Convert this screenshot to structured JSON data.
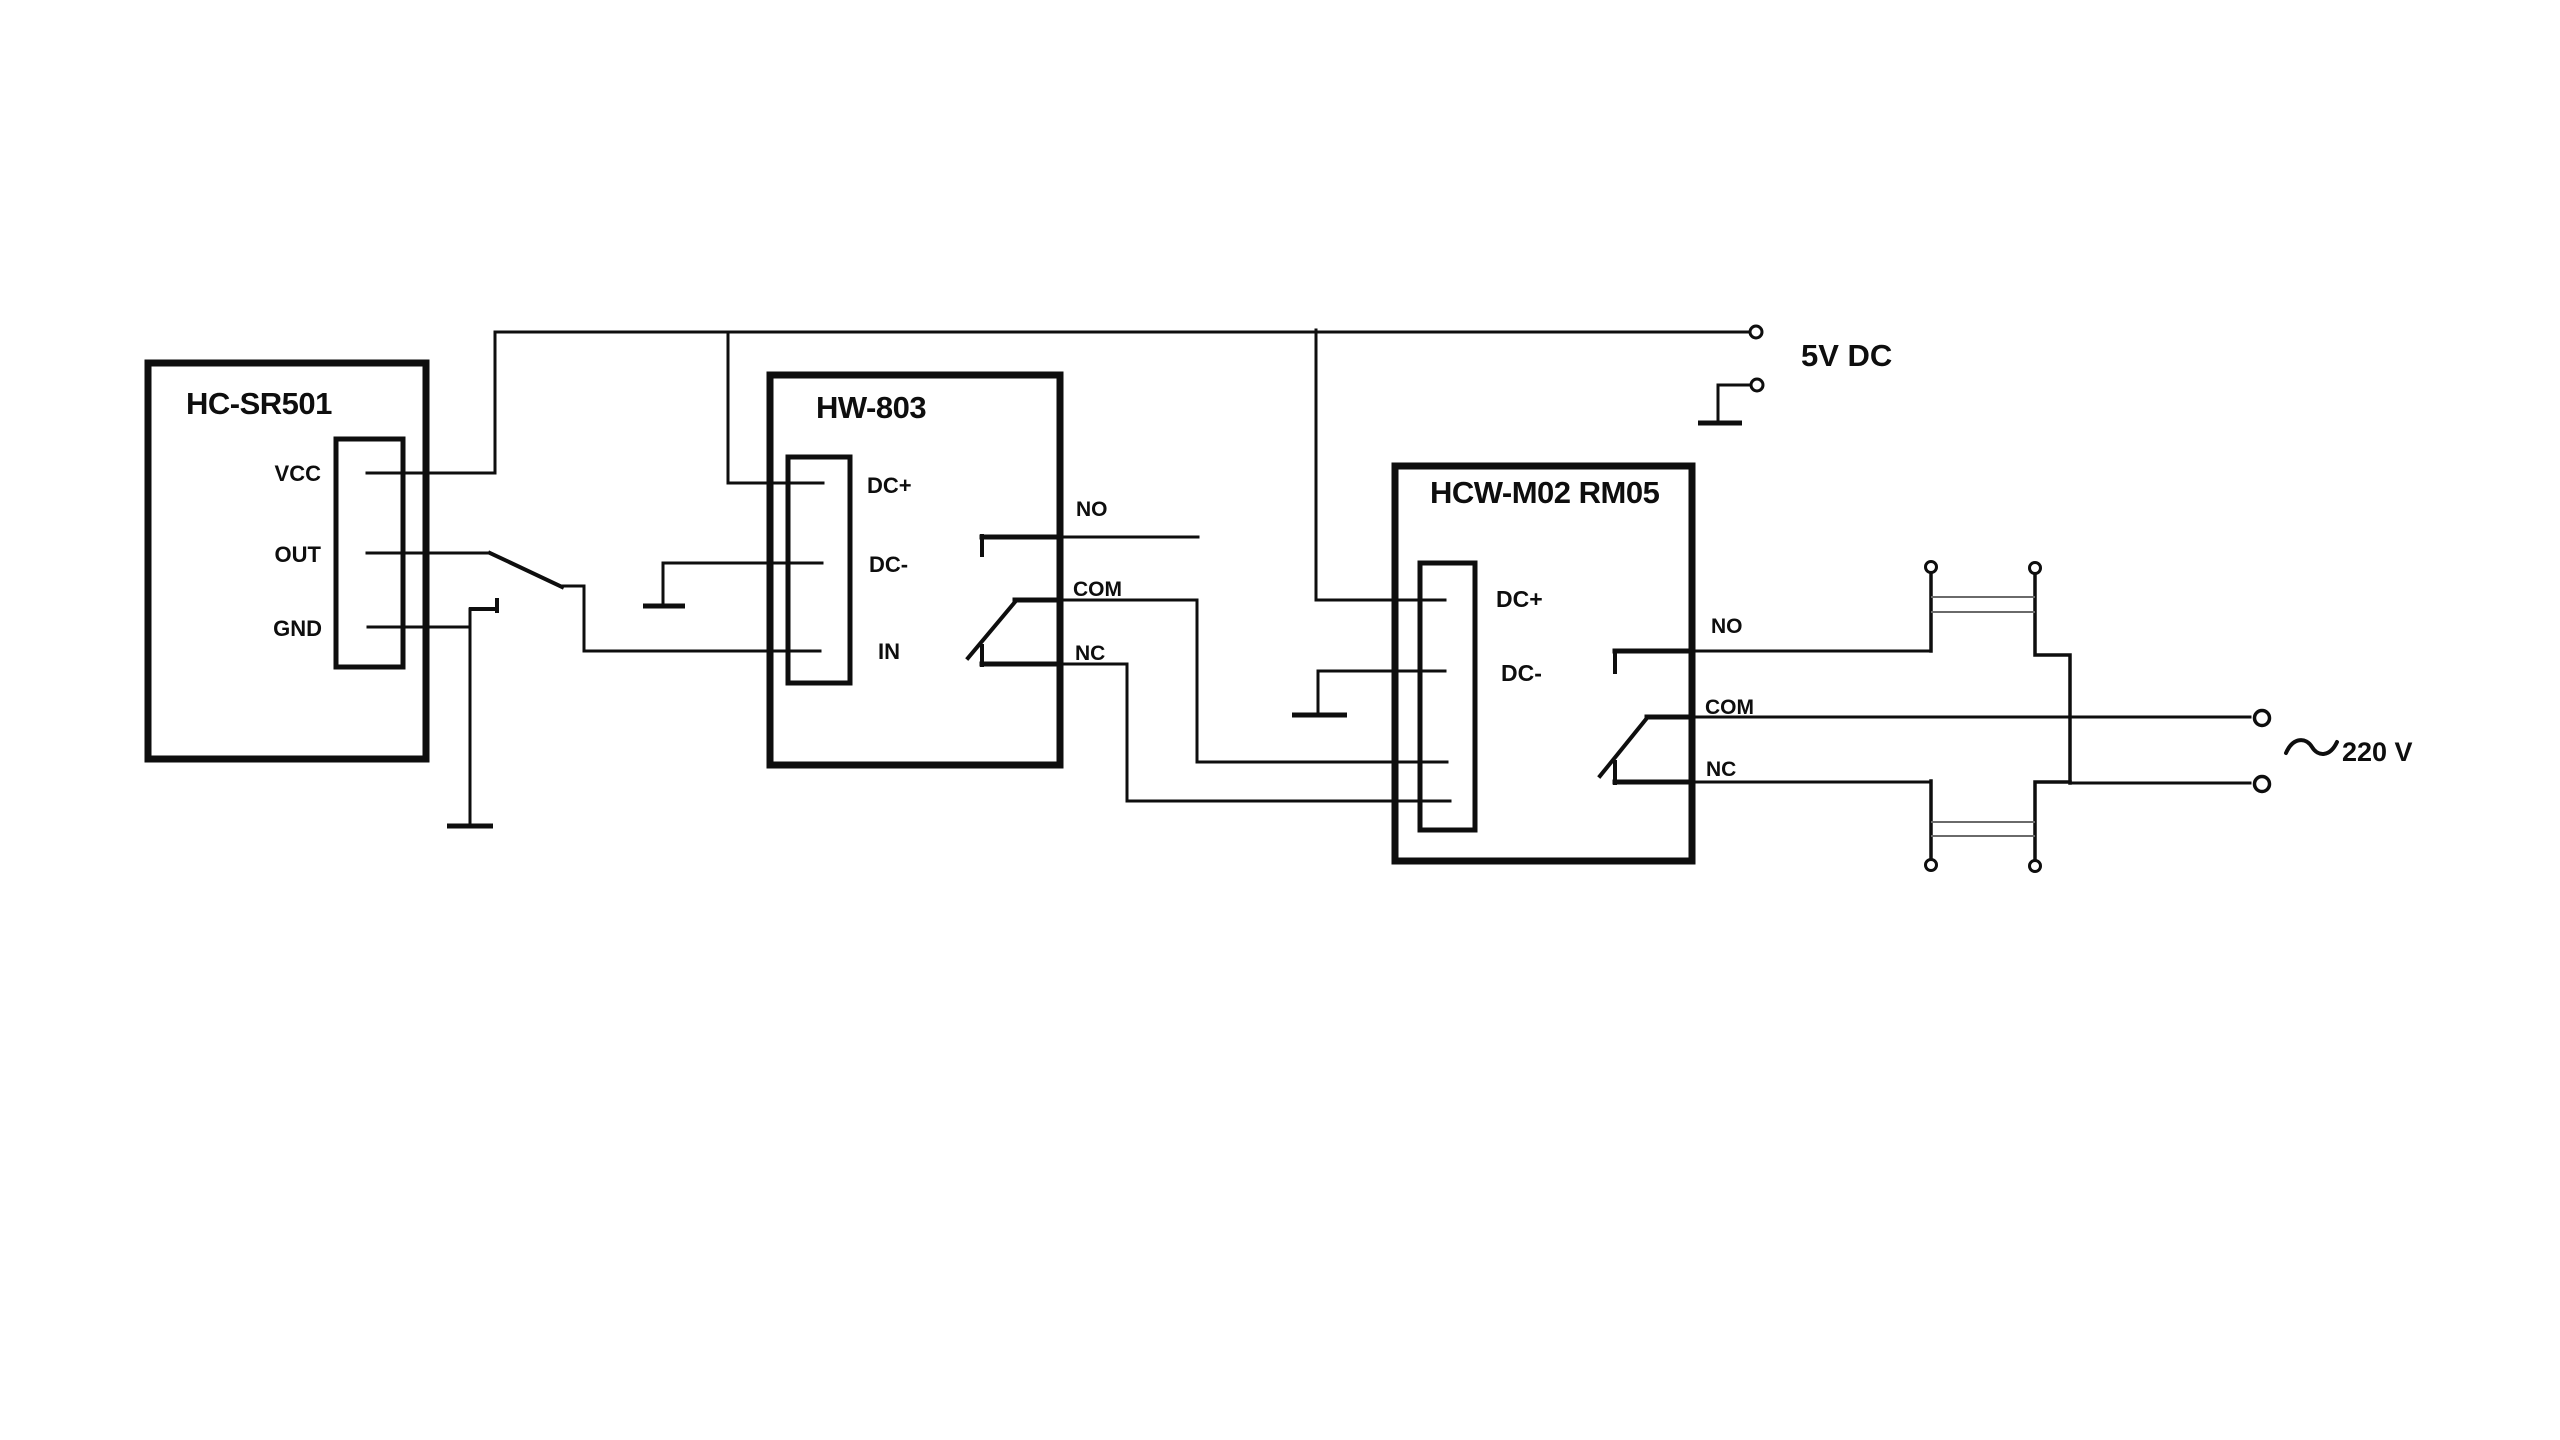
{
  "colors": {
    "ink": "#0e0e0e",
    "background": "#ffffff",
    "element_body": "#6a6a6a"
  },
  "modules": {
    "hc_sr501": {
      "title": "HC-SR501",
      "pins": {
        "vcc": "VCC",
        "out": "OUT",
        "gnd": "GND"
      }
    },
    "hw_803": {
      "title": "HW-803",
      "pins": {
        "dc_plus": "DC+",
        "dc_minus": "DC-",
        "in": "IN"
      },
      "contacts": {
        "no": "NO",
        "com": "COM",
        "nc": "NC"
      }
    },
    "hcw_m02_rm05": {
      "title": "HCW-M02 RM05",
      "pins": {
        "dc_plus": "DC+",
        "dc_minus": "DC-"
      },
      "contacts": {
        "no": "NO",
        "com": "COM",
        "nc": "NC"
      }
    }
  },
  "power": {
    "dc_supply": "5V DC",
    "ac_symbol": "~",
    "ac_supply": "220 V"
  }
}
